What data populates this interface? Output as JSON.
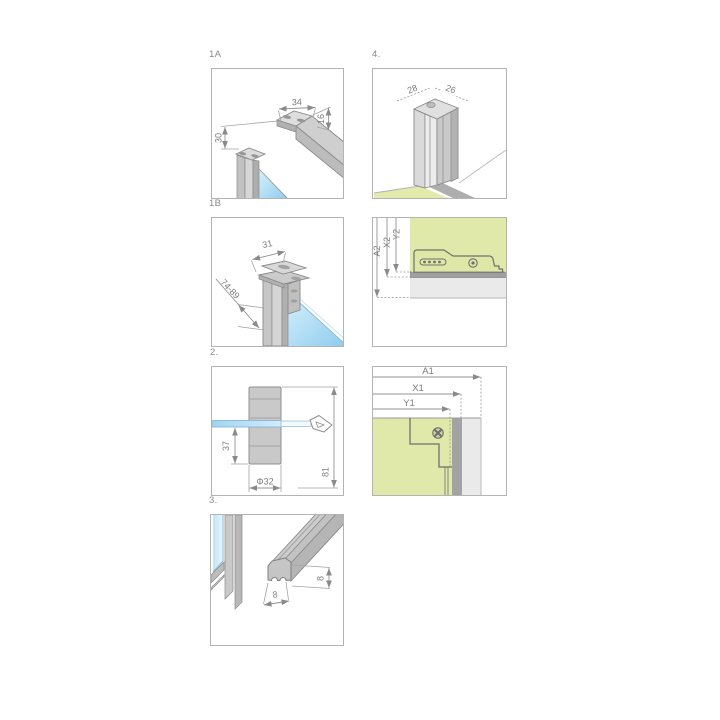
{
  "doc": {
    "type": "shower-enclosure-installation-diagram"
  },
  "colors": {
    "panel_border": "#b3b3b3",
    "label_gray": "#8a8a8a",
    "dim_gray": "#939393",
    "metal_light": "#dcdcdc",
    "metal_mid": "#c7c7c7",
    "metal_dark": "#b0b0b0",
    "outline": "#8a8a8a",
    "glass_blue_light": "#d4eefb",
    "glass_blue": "#8ccbed",
    "glass_edge": "#8fb9cf",
    "wall_green": "#e0e8aa",
    "rail_gray": "#9f9f9f",
    "strip_gray": "#eaeaea",
    "bar_blue": "#9ed5f2"
  },
  "panels": {
    "p1a": {
      "label": "1A",
      "dim_top": "34",
      "dim_right": "16",
      "dim_left": "30"
    },
    "p4": {
      "label": "4.",
      "dim_left": "28",
      "dim_right": "26"
    },
    "p1b": {
      "label": "1B",
      "dim_top": "31",
      "dim_diag": "74-89"
    },
    "pa2": {
      "dim_a": "A2",
      "dim_x": "X2",
      "dim_y": "Y2"
    },
    "p2": {
      "label": "2.",
      "dim_depth": "37",
      "dim_dia": "Φ32",
      "dim_len": "81"
    },
    "pa1": {
      "dim_a": "A1",
      "dim_x": "X1",
      "dim_y": "Y1"
    },
    "p3": {
      "label": "3.",
      "dim_w": "8",
      "dim_h": "8"
    }
  }
}
